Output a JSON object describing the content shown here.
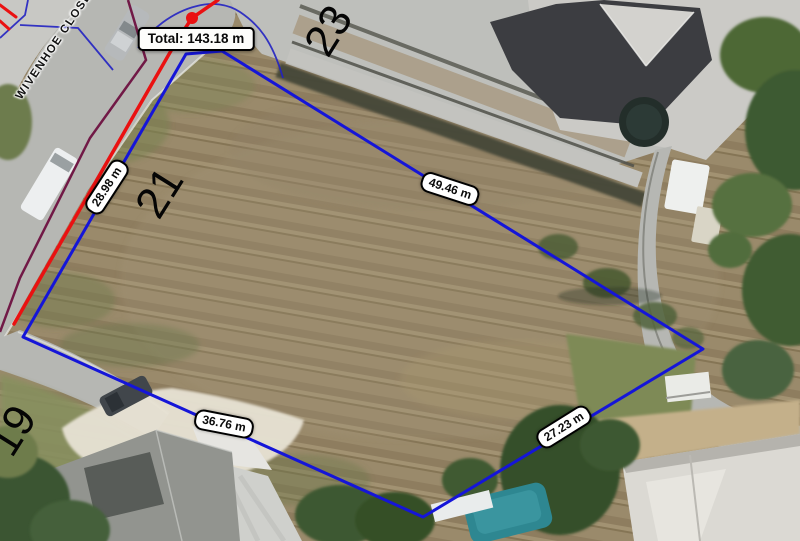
{
  "measure_tool": {
    "total": "Total: 143.18 m",
    "segments": [
      {
        "length": "28.98 m"
      },
      {
        "length": "49.46 m"
      },
      {
        "length": "36.76 m"
      },
      {
        "length": "27.23 m"
      }
    ]
  },
  "parcels": {
    "street": "WIVENHOE CLOSE",
    "lots": [
      {
        "number": "21"
      },
      {
        "number": "23"
      },
      {
        "number": "19"
      }
    ]
  },
  "colors": {
    "measured_boundary": "#1515d8",
    "active_measure_line": "#ea1111",
    "cadastral_line": "#2222c2",
    "utility_line": "#6e1040",
    "label_background": "#ffffff",
    "label_border": "#000000",
    "pool_water": "#2f8893"
  }
}
